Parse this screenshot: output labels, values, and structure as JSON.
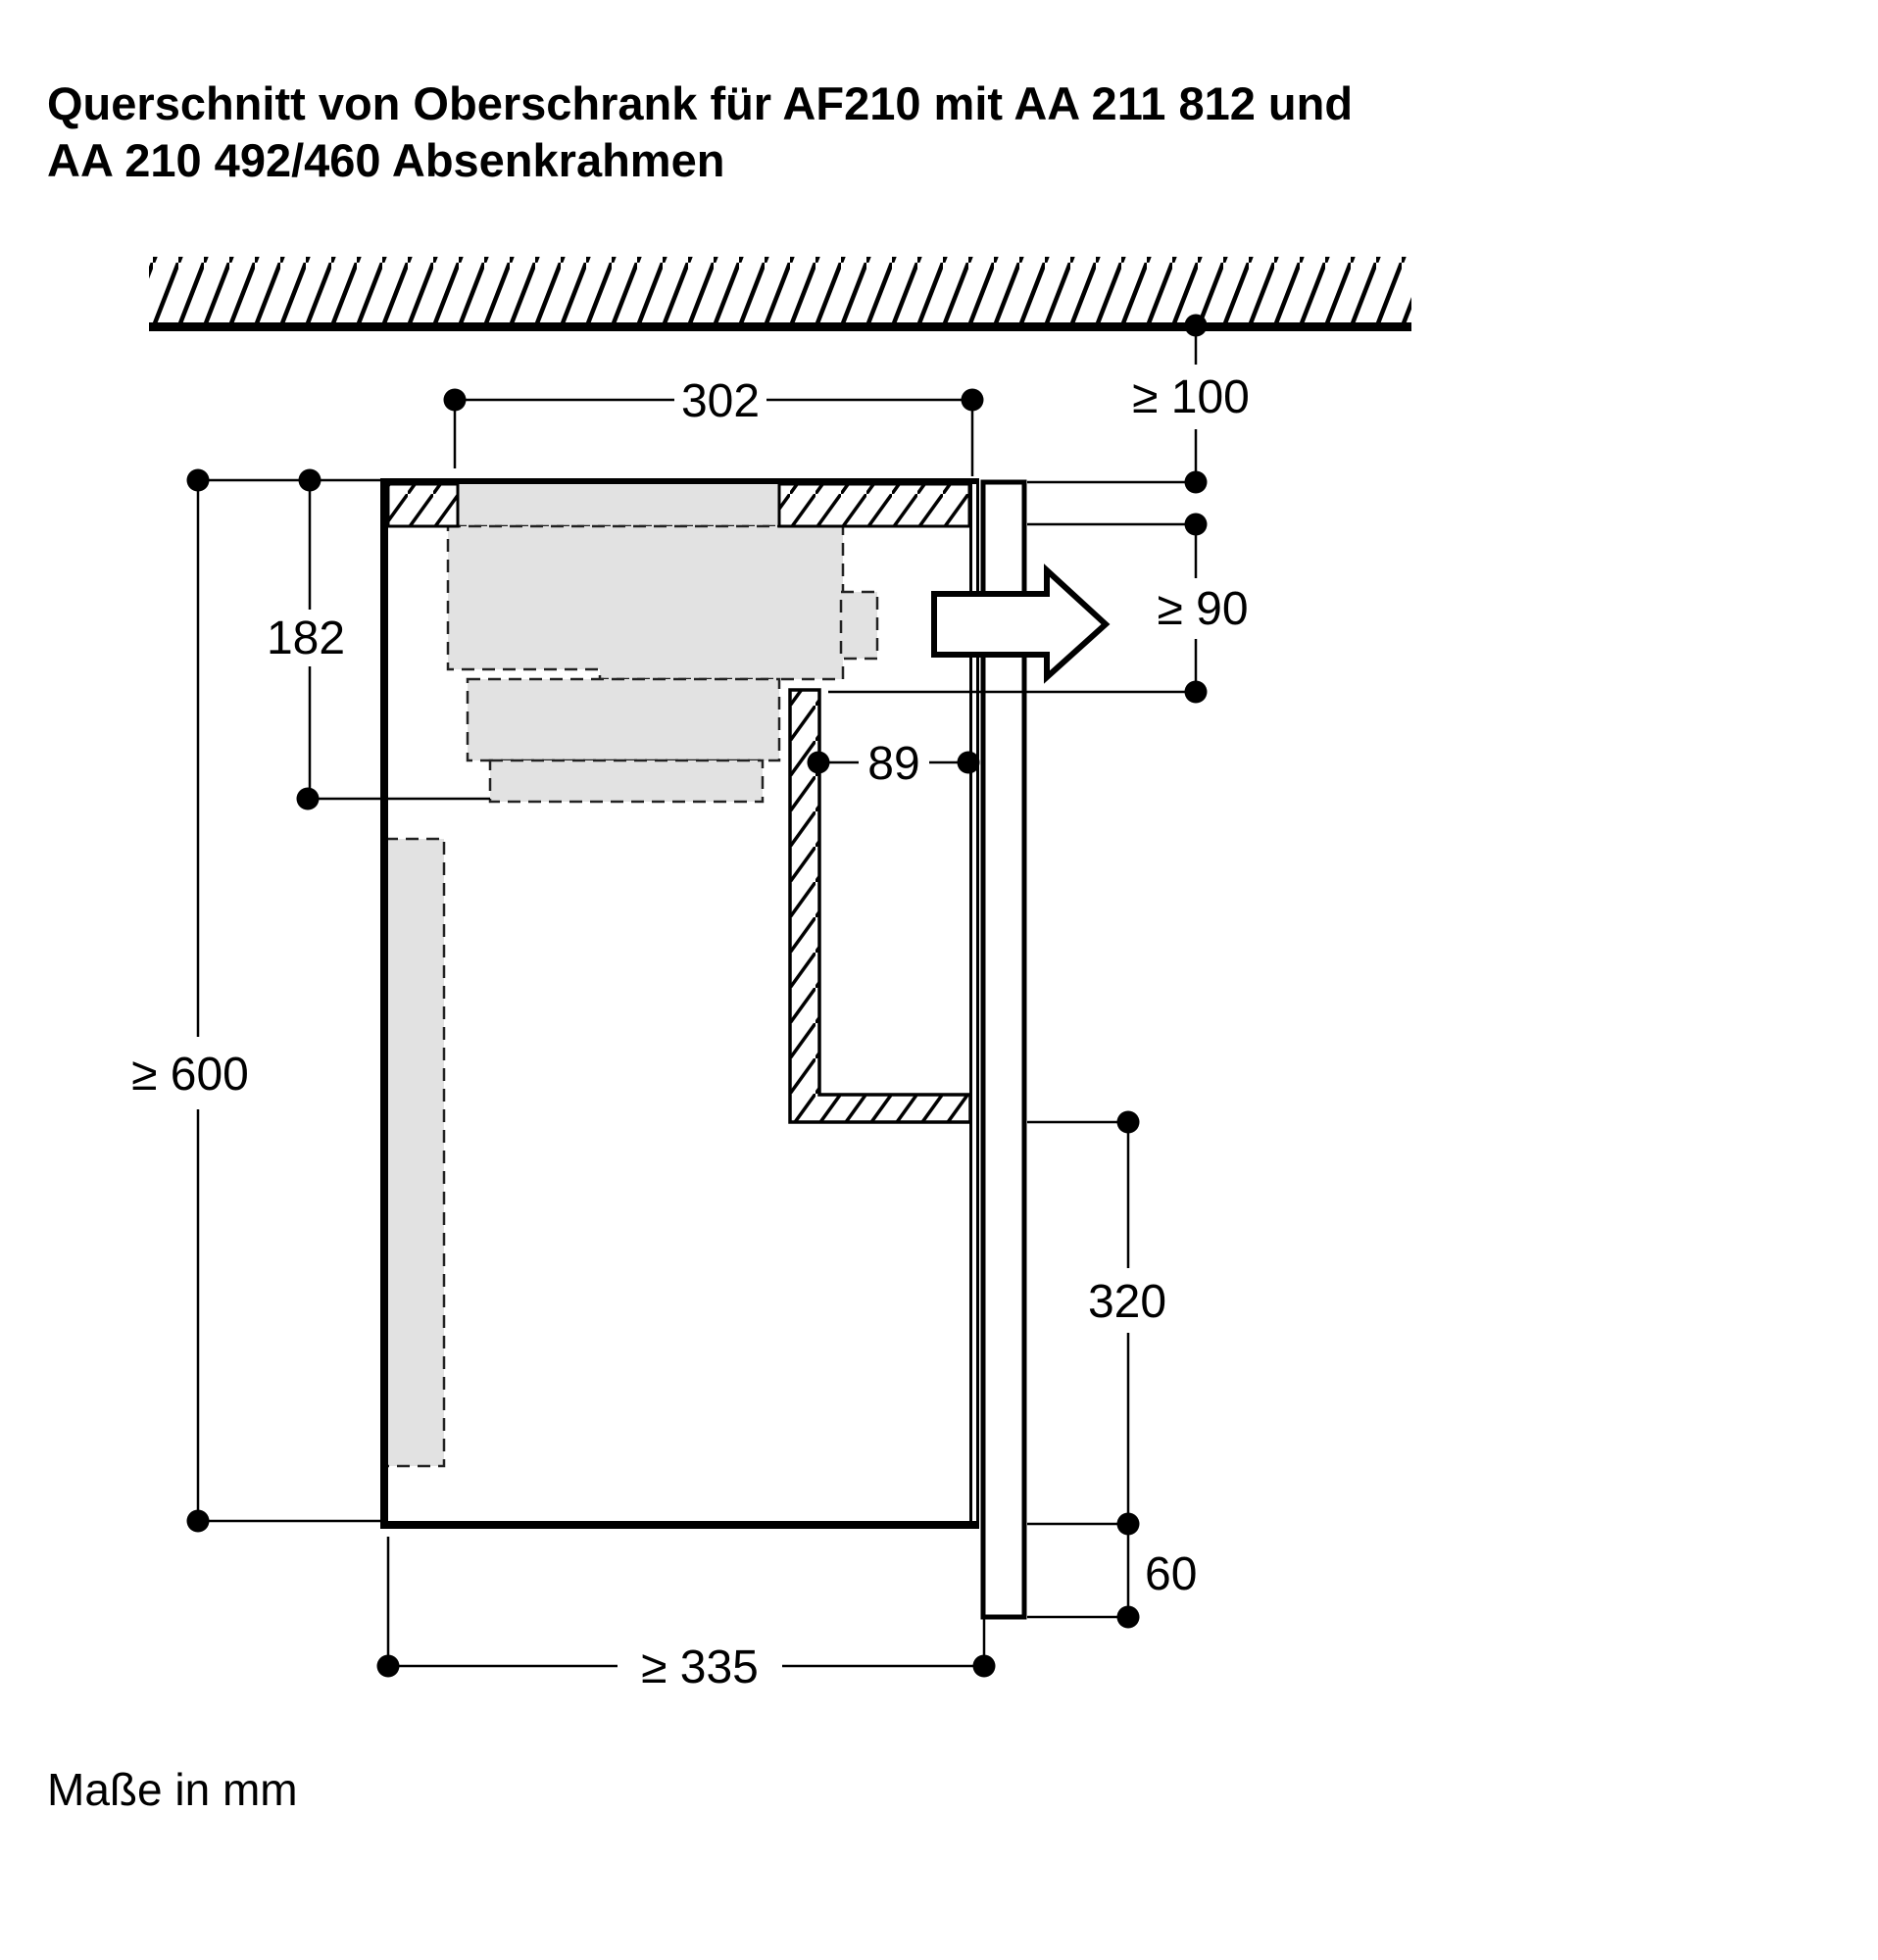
{
  "title": {
    "line1": "Querschnitt von Oberschrank für AF210 mit AA 211 812 und",
    "line2": "AA 210 492/460 Absenkrahmen"
  },
  "footnote": "Maße in mm",
  "dimensions": {
    "cutout_width": "302",
    "ceiling_distance": "≥ 100",
    "outlet_height": "≥ 90",
    "appliance_depth": "182",
    "duct_wall_gap": "89",
    "cabinet_height": "≥ 600",
    "duct_outlet_offset": "320",
    "panel_overhang": "60",
    "cabinet_depth": "≥ 335"
  },
  "colors": {
    "appliance_fill": "#e2e2e2",
    "line": "#000000",
    "background": "#ffffff"
  }
}
